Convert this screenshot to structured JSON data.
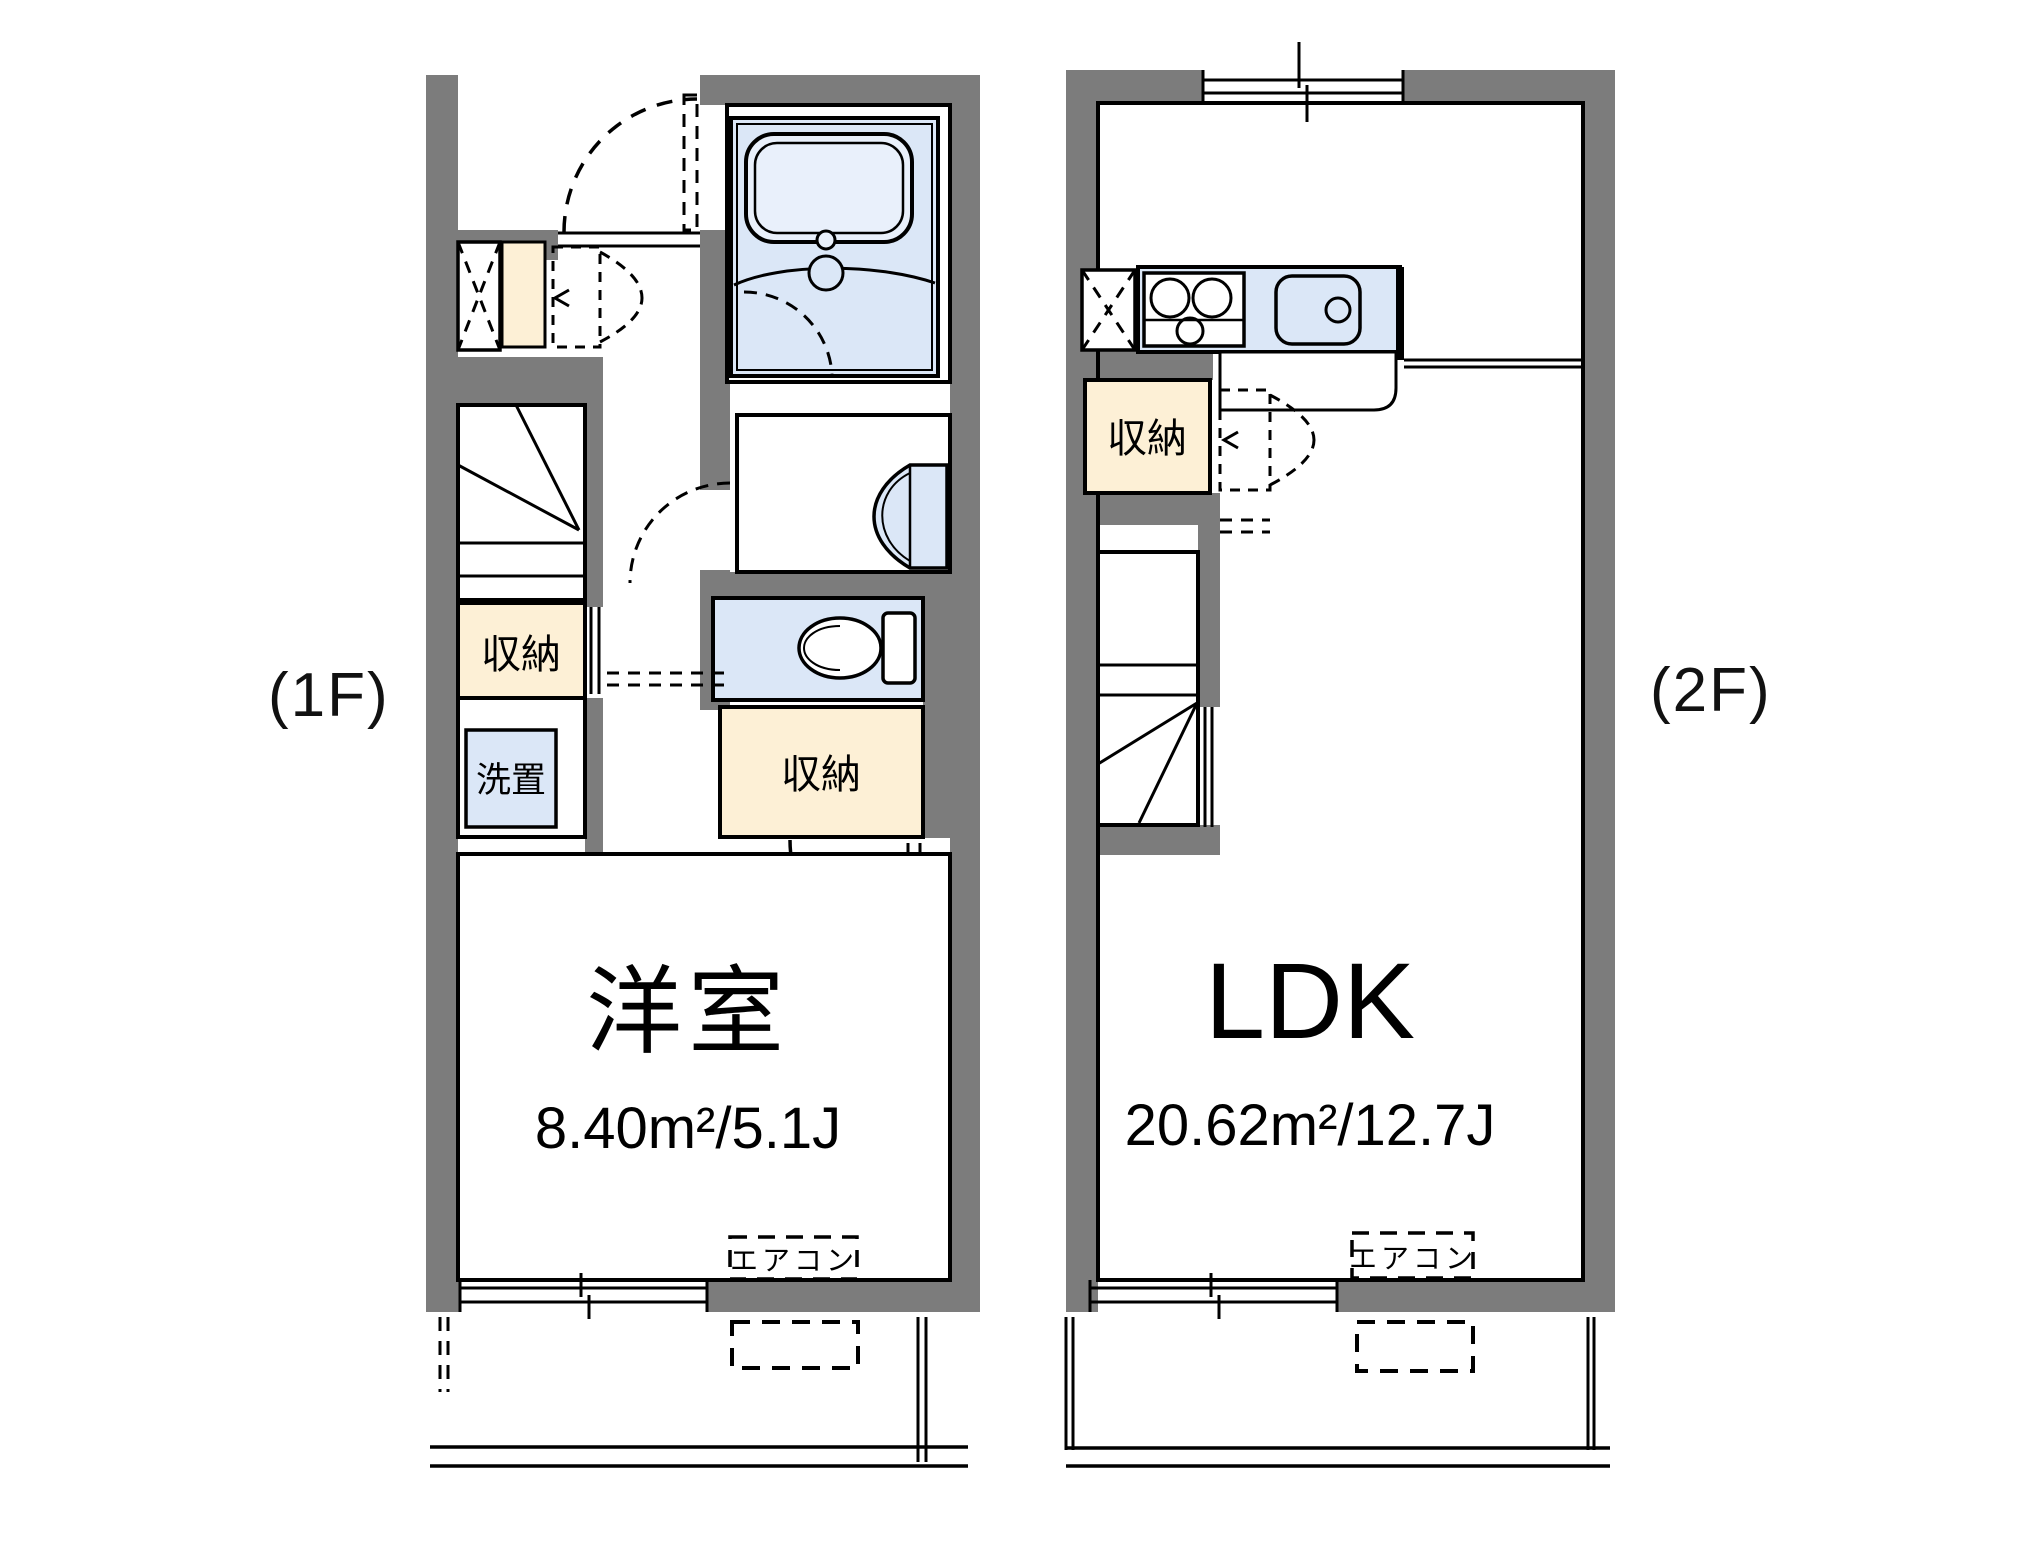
{
  "colors": {
    "wall": "#7c7c7c",
    "fixture_blue": "#dbe7f7",
    "fixture_blue_light": "#e9f0fb",
    "storage_beige": "#fdf0d6",
    "line": "#000000"
  },
  "floor1": {
    "floor_label": "(1F)",
    "room_name": "洋室",
    "room_area": "8.40m²/5.1J",
    "hall_storage_label": "収納",
    "left_storage_label": "収納",
    "washer_label": "洗置",
    "aircon_label": "エアコン"
  },
  "floor2": {
    "floor_label": "(2F)",
    "room_name": "LDK",
    "room_area": "20.62m²/12.7J",
    "storage_label": "収納",
    "aircon_label": "エアコン"
  }
}
